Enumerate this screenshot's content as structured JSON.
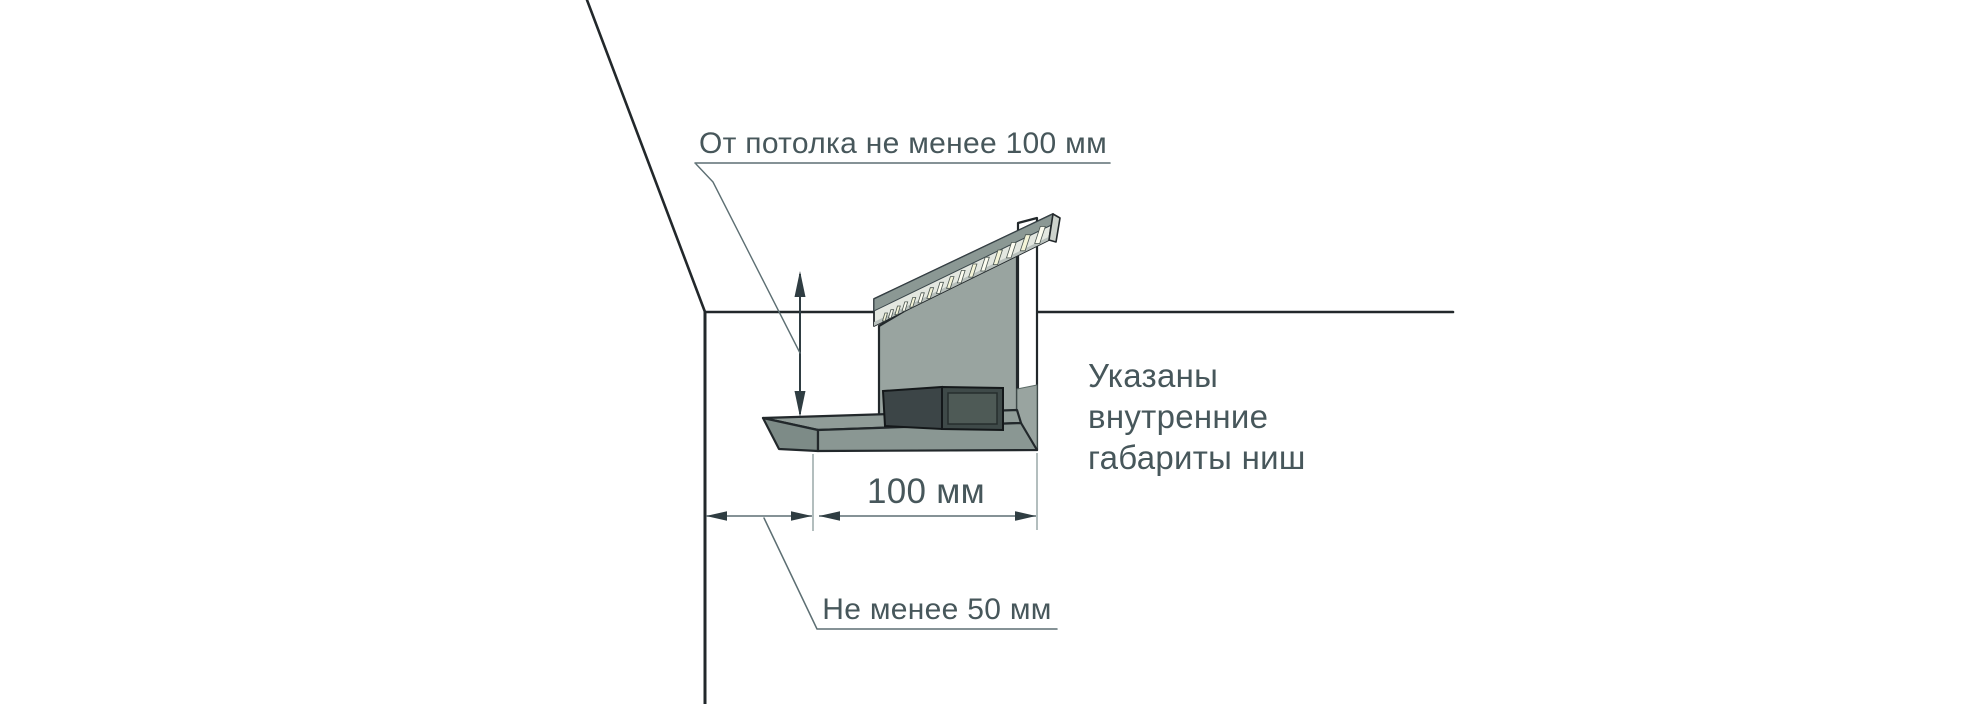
{
  "diagram": {
    "labels": {
      "ceiling_clearance": "От потолка не менее 100 мм",
      "niche_width": "100 мм",
      "wall_clearance": "Не менее 50 мм",
      "note_lines": [
        "Указаны",
        "внутренние",
        "габариты ниш"
      ]
    },
    "colors": {
      "background": "#ffffff",
      "outline": "#22282b",
      "panel": "#99a4a0",
      "strip_band": "#8b9894",
      "led_row": "#e3e7e0",
      "strip_edge": "#b9c1bd",
      "strip_cap": "#ccd2cc",
      "led_tick_cream": "#f4f4d8",
      "led_tick_white": "#fcfcf0",
      "shelf_top": "#909c98",
      "shelf_bevel": "#7d8b87",
      "shelf_front": "#8a9793",
      "box_dark": "#3c4547",
      "box_right": "#3f4a49",
      "box_inner": "#4e5a56",
      "dim_line": "#5d6f73",
      "dim_arrow": "#2f3d42",
      "extension_line": "#8a9a9a",
      "text": "#47575b"
    }
  }
}
